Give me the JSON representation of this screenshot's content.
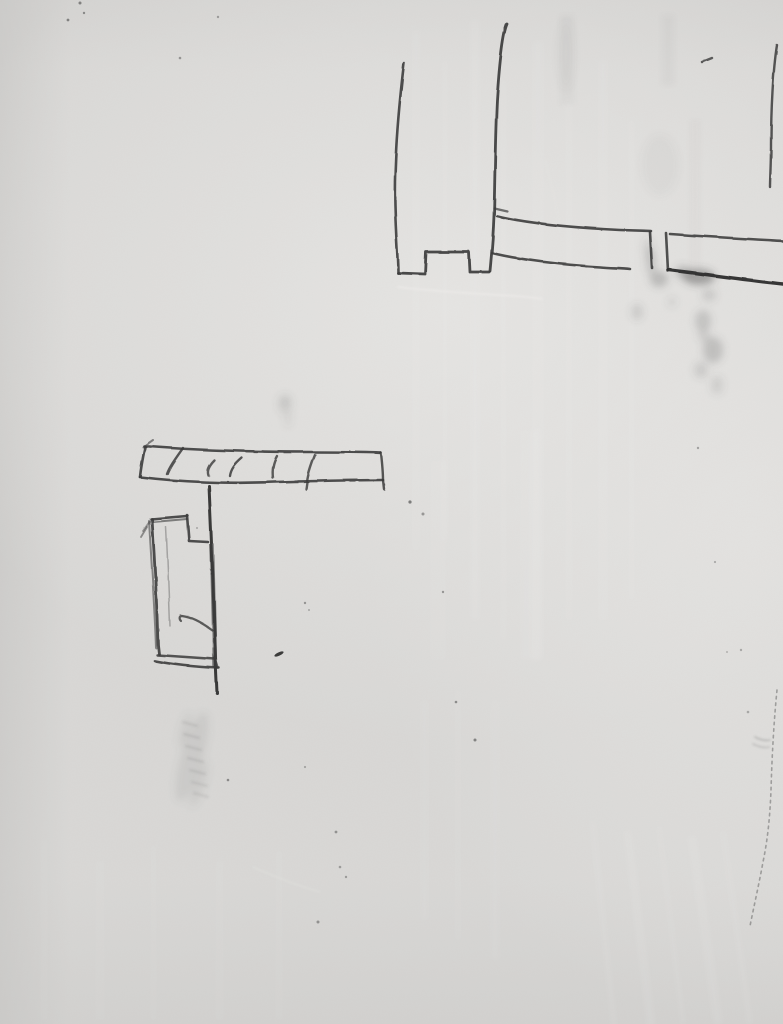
{
  "meta": {
    "description": "Photograph of a white painted wall bearing hand-drawn pencil construction sketches: a post-with-notch and horizontal rail detail at top right, and a hatched bar with a small stepped bracket rectangle at middle left, plus graphite smudges, specks, brush-stroke paint texture and a faint crack near the right edge.",
    "image_type": "photo",
    "width": 783,
    "height": 1024
  },
  "palette": {
    "wall_base": "#d9d8d6",
    "wall_light": "#e6e5e3",
    "wall_shadow": "#c8c7c5",
    "pencil": "#3a3a3a",
    "pencil_dark": "#2b2b2b",
    "smudge_gray": "#5a5a5a",
    "scar_white": "#f0efed"
  },
  "scene": {
    "sketches": [
      {
        "name": "post-and-rail-sketch",
        "strokes": [
          {
            "name": "post-left-line",
            "d": "M404,63 C399,105 394,160 395,205 C396,240 398,258 398,273",
            "w": 2.6,
            "o": 0.9
          },
          {
            "name": "post-bottom-notch",
            "d": "M398,273 L425,274 L426,252 L469,252 L470,272 L489,272",
            "w": 2.8,
            "o": 0.92
          },
          {
            "name": "post-right-line",
            "d": "M507,24 C502,35 499,70 497,100 C495,140 495,180 494,215 C493,242 491,260 490,271",
            "w": 2.8,
            "o": 0.92
          },
          {
            "name": "rail-tick",
            "d": "M494,208 L507,211",
            "w": 2.2,
            "o": 0.7
          },
          {
            "name": "rail1-top-edge",
            "d": "M497,216 C530,224 580,228 620,230 L651,231",
            "w": 2.6,
            "o": 0.9
          },
          {
            "name": "rail1-end-line",
            "d": "M650,232 L652,268",
            "w": 2.6,
            "o": 0.9
          },
          {
            "name": "rail1-bottom-edge",
            "d": "M492,253 C520,260 565,265 600,267 C610,268 622,268 630,269",
            "w": 2.6,
            "o": 0.9
          },
          {
            "name": "rail2-start-line",
            "d": "M666,233 L668,271",
            "w": 2.6,
            "o": 0.88
          },
          {
            "name": "rail2-top-edge",
            "d": "M670,234 C710,237 750,239 783,241",
            "w": 2.6,
            "o": 0.88
          },
          {
            "name": "rail2-bottom-edge",
            "d": "M669,270 C705,274 745,280 783,284",
            "w": 3.4,
            "o": 0.95,
            "c": "#2b2b2b"
          },
          {
            "name": "right-short-line",
            "d": "M777,45 C773,70 771,110 771,145 C771,165 770,178 770,187",
            "w": 2.4,
            "o": 0.85
          },
          {
            "name": "top-dash",
            "d": "M702,62 L712,58",
            "w": 2.4,
            "o": 0.8
          }
        ]
      },
      {
        "name": "hatched-bar-bracket-sketch",
        "strokes": [
          {
            "name": "bar-top-edge",
            "d": "M144,446 C190,450 255,452 310,452 C340,452 365,452 381,453",
            "w": 2.6,
            "o": 0.9
          },
          {
            "name": "bar-top-hook",
            "d": "M143,447 L153,440",
            "w": 2.0,
            "o": 0.6
          },
          {
            "name": "bar-left-edge",
            "d": "M145,447 C143,457 141,467 140,477",
            "w": 2.6,
            "o": 0.9
          },
          {
            "name": "bar-bottom-edge",
            "d": "M140,477 C180,482 230,484 275,482 C315,481 355,480 383,480",
            "w": 2.6,
            "o": 0.9
          },
          {
            "name": "bar-right-edge",
            "d": "M381,453 C382,462 383,471 383,480 L384,489",
            "w": 2.4,
            "o": 0.85
          },
          {
            "name": "hatch-1",
            "d": "M183,448 C176,458 170,466 167,474",
            "w": 2.4,
            "o": 0.85
          },
          {
            "name": "hatch-2",
            "d": "M214,460 C209,465 206,470 208,475",
            "w": 2.4,
            "o": 0.8
          },
          {
            "name": "hatch-3",
            "d": "M242,458 C235,464 231,469 230,476",
            "w": 2.4,
            "o": 0.85
          },
          {
            "name": "hatch-4",
            "d": "M277,456 C273,463 272,470 273,478",
            "w": 2.4,
            "o": 0.8
          },
          {
            "name": "hatch-5",
            "d": "M315,455 C311,465 308,474 307,482 L306,489",
            "w": 2.4,
            "o": 0.8
          },
          {
            "name": "stem-line",
            "d": "M209,486 C211,530 213,575 214,615 C215,648 216,672 217,693",
            "w": 3.0,
            "o": 0.95,
            "c": "#2e2e2e"
          },
          {
            "name": "stem-thick-overdraw",
            "d": "M212,545 C213,590 214,630 215,666",
            "w": 4.5,
            "o": 0.6
          },
          {
            "name": "rect-top-edge",
            "d": "M151,519 L187,516",
            "w": 2.6,
            "o": 0.9
          },
          {
            "name": "rect-top-edge-2",
            "d": "M153,522 L187,519",
            "w": 2.0,
            "o": 0.6
          },
          {
            "name": "rect-step",
            "d": "M187,515 L189,541 L208,542",
            "w": 2.6,
            "o": 0.9
          },
          {
            "name": "rect-left-edge",
            "d": "M152,519 C155,565 157,610 158,645 L159,654",
            "w": 2.8,
            "o": 0.9
          },
          {
            "name": "rect-left-edge-2",
            "d": "M149,521 C152,570 155,615 156,648",
            "w": 2.0,
            "o": 0.55
          },
          {
            "name": "rect-flick-1",
            "d": "M147,527 L141,537",
            "w": 1.8,
            "o": 0.5
          },
          {
            "name": "rect-flick-2",
            "d": "M150,521 L143,531",
            "w": 1.8,
            "o": 0.45
          },
          {
            "name": "rect-bottom-edge",
            "d": "M157,655 L215,659",
            "w": 2.4,
            "o": 0.85
          },
          {
            "name": "rect-bottom-edge-2",
            "d": "M155,661 C175,665 198,667 219,668",
            "w": 2.6,
            "o": 0.9
          },
          {
            "name": "rect-bottom-right",
            "d": "M215,658 L218,668",
            "w": 2.4,
            "o": 0.8
          },
          {
            "name": "rect-inner-line",
            "d": "M166,527 C168,565 169,600 170,626",
            "w": 1.5,
            "o": 0.35
          },
          {
            "name": "inner-hook-curve",
            "d": "M212,630 C201,622 190,617 182,616 C179,616 179,619 181,621",
            "w": 2.2,
            "o": 0.8
          }
        ]
      }
    ],
    "faint_strokes": [
      {
        "name": "band-tick",
        "d": "M183,722 L197,726",
        "w": 2,
        "o": 0.14
      },
      {
        "name": "band-tick",
        "d": "M184,734 L199,738",
        "w": 2,
        "o": 0.15
      },
      {
        "name": "band-tick",
        "d": "M186,746 L201,750",
        "w": 2,
        "o": 0.14
      },
      {
        "name": "band-tick",
        "d": "M188,758 L203,762",
        "w": 2,
        "o": 0.15
      },
      {
        "name": "band-tick",
        "d": "M190,770 L205,774",
        "w": 2,
        "o": 0.14
      },
      {
        "name": "band-tick",
        "d": "M192,782 L207,786",
        "w": 2,
        "o": 0.13
      },
      {
        "name": "band-tick",
        "d": "M194,793 L208,797",
        "w": 2,
        "o": 0.12
      },
      {
        "name": "crack-scribble",
        "d": "M755,737 C760,740 766,741 770,740",
        "w": 1.4,
        "o": 0.3
      },
      {
        "name": "crack-scribble",
        "d": "M753,744 C759,747 765,748 769,747",
        "w": 1.4,
        "o": 0.25
      }
    ],
    "smudges": [
      {
        "cx": 651,
        "cy": 262,
        "rx": 5,
        "ry": 13,
        "o": 0.22
      },
      {
        "cx": 659,
        "cy": 279,
        "rx": 9,
        "ry": 8,
        "o": 0.28
      },
      {
        "cx": 648,
        "cy": 248,
        "rx": 4,
        "ry": 10,
        "o": 0.15
      },
      {
        "cx": 699,
        "cy": 277,
        "rx": 16,
        "ry": 8,
        "o": 0.42,
        "c": "#4a4a4a"
      },
      {
        "cx": 683,
        "cy": 272,
        "rx": 8,
        "ry": 6,
        "o": 0.3
      },
      {
        "cx": 709,
        "cy": 295,
        "rx": 7,
        "ry": 6,
        "o": 0.18
      },
      {
        "cx": 703,
        "cy": 321,
        "rx": 8,
        "ry": 11,
        "o": 0.22
      },
      {
        "cx": 713,
        "cy": 350,
        "rx": 10,
        "ry": 13,
        "o": 0.25
      },
      {
        "cx": 704,
        "cy": 336,
        "rx": 6,
        "ry": 6,
        "o": 0.15
      },
      {
        "cx": 701,
        "cy": 370,
        "rx": 7,
        "ry": 8,
        "o": 0.16
      },
      {
        "cx": 717,
        "cy": 385,
        "rx": 6,
        "ry": 9,
        "o": 0.14
      },
      {
        "cx": 637,
        "cy": 312,
        "rx": 6,
        "ry": 8,
        "o": 0.16
      },
      {
        "cx": 672,
        "cy": 302,
        "rx": 4,
        "ry": 5,
        "o": 0.12
      },
      {
        "cx": 660,
        "cy": 165,
        "rx": 18,
        "ry": 30,
        "o": 0.05
      },
      {
        "cx": 566,
        "cy": 55,
        "rx": 8,
        "ry": 35,
        "o": 0.05
      },
      {
        "cx": 285,
        "cy": 404,
        "rx": 7,
        "ry": 10,
        "o": 0.13
      },
      {
        "cx": 285,
        "cy": 402,
        "rx": 2,
        "ry": 2,
        "o": 0.4
      },
      {
        "cx": 288,
        "cy": 419,
        "rx": 3,
        "ry": 8,
        "o": 0.1
      },
      {
        "cx": 192,
        "cy": 757,
        "rx": 11,
        "ry": 46,
        "o": 0.12,
        "rot": 16,
        "c": "#6a6a68"
      },
      {
        "cx": 185,
        "cy": 730,
        "rx": 5,
        "ry": 18,
        "o": 0.1,
        "rot": 14,
        "c": "#6a6a68"
      },
      {
        "cx": 199,
        "cy": 784,
        "rx": 6,
        "ry": 24,
        "o": 0.1,
        "rot": 18,
        "c": "#6a6a68"
      }
    ],
    "marks": [
      {
        "cx": 279,
        "cy": 654,
        "rx": 5,
        "ry": 1.7,
        "rot": -25,
        "o": 0.85,
        "c": "#1f1f1f"
      }
    ],
    "specks": [
      {
        "x": 68,
        "y": 20,
        "r": 1.4,
        "o": 0.5
      },
      {
        "x": 84,
        "y": 13,
        "r": 1.2,
        "o": 0.45
      },
      {
        "x": 80,
        "y": 3,
        "r": 1.5,
        "o": 0.5
      },
      {
        "x": 180,
        "y": 58,
        "r": 1.3,
        "o": 0.4
      },
      {
        "x": 218,
        "y": 17,
        "r": 1.2,
        "o": 0.35
      },
      {
        "x": 410,
        "y": 502,
        "r": 1.6,
        "o": 0.55
      },
      {
        "x": 423,
        "y": 514,
        "r": 1.5,
        "o": 0.4
      },
      {
        "x": 443,
        "y": 592,
        "r": 1.2,
        "o": 0.4
      },
      {
        "x": 305,
        "y": 603,
        "r": 1.2,
        "o": 0.4
      },
      {
        "x": 309,
        "y": 610,
        "r": 1.0,
        "o": 0.3
      },
      {
        "x": 228,
        "y": 780,
        "r": 1.3,
        "o": 0.45
      },
      {
        "x": 197,
        "y": 528,
        "r": 1.0,
        "o": 0.3
      },
      {
        "x": 336,
        "y": 832,
        "r": 1.4,
        "o": 0.4
      },
      {
        "x": 340,
        "y": 867,
        "r": 1.3,
        "o": 0.35
      },
      {
        "x": 346,
        "y": 877,
        "r": 1.2,
        "o": 0.35
      },
      {
        "x": 318,
        "y": 922,
        "r": 1.5,
        "o": 0.4
      },
      {
        "x": 305,
        "y": 767,
        "r": 1.1,
        "o": 0.3
      },
      {
        "x": 456,
        "y": 702,
        "r": 1.3,
        "o": 0.45
      },
      {
        "x": 475,
        "y": 740,
        "r": 1.5,
        "o": 0.5
      },
      {
        "x": 698,
        "y": 448,
        "r": 1.2,
        "o": 0.35
      },
      {
        "x": 715,
        "y": 562,
        "r": 1.1,
        "o": 0.3
      },
      {
        "x": 741,
        "y": 650,
        "r": 1.2,
        "o": 0.3
      },
      {
        "x": 727,
        "y": 652,
        "r": 1.0,
        "o": 0.25
      },
      {
        "x": 748,
        "y": 712,
        "r": 1.3,
        "o": 0.3
      }
    ],
    "cracks": [
      {
        "name": "right-edge-crack",
        "d": "M777,690 C774,720 772,755 771,790 C770,815 768,838 763,862 C759,884 754,906 750,926",
        "w": 1.6,
        "o": 0.45,
        "dash": "2.5 4",
        "c": "#4f4f4f"
      }
    ],
    "scars": [
      {
        "name": "plaster-scar",
        "d": "M398,287 C430,291 480,294 516,296 C528,297 536,298 542,299",
        "w": 2.2,
        "o": 0.55,
        "c": "#f0efed"
      },
      {
        "name": "plaster-scar",
        "d": "M253,867 C280,879 302,887 320,892",
        "w": 1.6,
        "o": 0.3,
        "c": "#eceae8"
      },
      {
        "name": "plaster-scar",
        "d": "M545,160 C552,185 558,210 560,232",
        "w": 1.6,
        "o": 0.25,
        "c": "#ecebe9"
      }
    ],
    "streaks": [
      {
        "x": 412,
        "y": 30,
        "w": 8,
        "h": 520,
        "o": 0.06
      },
      {
        "x": 442,
        "y": 60,
        "w": 6,
        "h": 480,
        "o": 0.05
      },
      {
        "x": 470,
        "y": 20,
        "w": 10,
        "h": 600,
        "o": 0.07
      },
      {
        "x": 500,
        "y": 80,
        "w": 7,
        "h": 560,
        "o": 0.05
      },
      {
        "x": 532,
        "y": 40,
        "w": 12,
        "h": 620,
        "o": 0.06
      },
      {
        "x": 565,
        "y": 100,
        "w": 8,
        "h": 520,
        "o": 0.05
      },
      {
        "x": 598,
        "y": 60,
        "w": 10,
        "h": 560,
        "o": 0.06
      },
      {
        "x": 628,
        "y": 120,
        "w": 7,
        "h": 480,
        "o": 0.05
      },
      {
        "x": 430,
        "y": 460,
        "w": 16,
        "h": 200,
        "o": 0.05
      },
      {
        "x": 520,
        "y": 430,
        "w": 20,
        "h": 230,
        "o": 0.06
      },
      {
        "x": 560,
        "y": 15,
        "w": 14,
        "h": 90,
        "o": 0.05,
        "c": "#8d8c8a"
      },
      {
        "x": 662,
        "y": 15,
        "w": 12,
        "h": 70,
        "o": 0.07,
        "c": "#8d8c8a"
      },
      {
        "x": 690,
        "y": 120,
        "w": 10,
        "h": 160,
        "o": 0.04,
        "c": "#8d8c8a"
      },
      {
        "x": 40,
        "y": 840,
        "w": 8,
        "h": 180,
        "o": 0.04
      },
      {
        "x": 95,
        "y": 860,
        "w": 10,
        "h": 160,
        "o": 0.04
      },
      {
        "x": 150,
        "y": 845,
        "w": 7,
        "h": 175,
        "o": 0.04
      },
      {
        "x": 215,
        "y": 860,
        "w": 9,
        "h": 160,
        "o": 0.04
      },
      {
        "x": 275,
        "y": 850,
        "w": 8,
        "h": 170,
        "o": 0.04
      },
      {
        "x": 420,
        "y": 700,
        "w": 9,
        "h": 220,
        "o": 0.05
      },
      {
        "x": 455,
        "y": 690,
        "w": 6,
        "h": 250,
        "o": 0.05
      },
      {
        "x": 490,
        "y": 700,
        "w": 10,
        "h": 260,
        "o": 0.05
      },
      {
        "x": 600,
        "y": 820,
        "w": 7,
        "h": 210,
        "o": 0.06,
        "rot": -6
      },
      {
        "x": 635,
        "y": 830,
        "w": 9,
        "h": 200,
        "o": 0.07,
        "rot": -7
      },
      {
        "x": 668,
        "y": 825,
        "w": 6,
        "h": 200,
        "o": 0.06,
        "rot": -7
      },
      {
        "x": 700,
        "y": 835,
        "w": 10,
        "h": 190,
        "o": 0.07,
        "rot": -8
      },
      {
        "x": 733,
        "y": 830,
        "w": 7,
        "h": 195,
        "o": 0.06,
        "rot": -8
      }
    ]
  }
}
